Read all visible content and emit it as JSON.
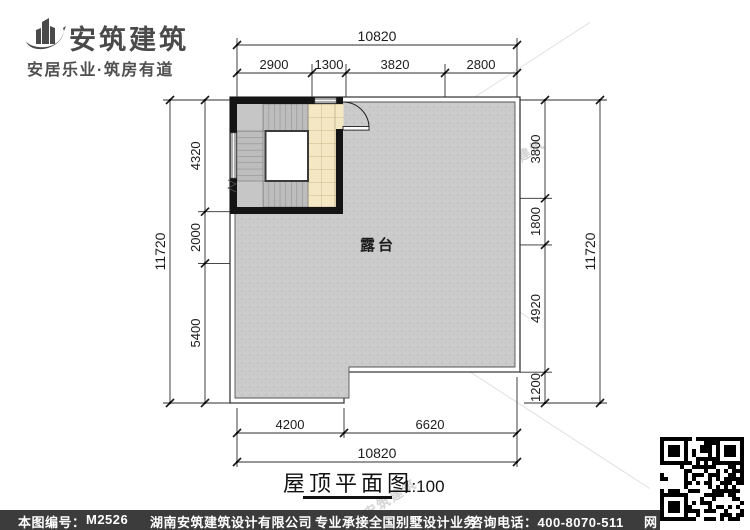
{
  "logo": {
    "title": "安筑建筑",
    "tagline": "安居乐业·筑房有道"
  },
  "plan": {
    "room_label": "露台"
  },
  "dims": {
    "top_total": "10820",
    "top_segments": [
      "2900",
      "1300",
      "3820",
      "2800"
    ],
    "left_total": "11720",
    "left_segments": [
      "4320",
      "2000",
      "5400"
    ],
    "right_total": "11720",
    "right_segments": [
      "3800",
      "1800",
      "4920",
      "1200"
    ],
    "bottom_segments": [
      "4200",
      "6620"
    ],
    "bottom_total": "10820"
  },
  "title_block": {
    "title": "屋顶平面图",
    "scale": "1:100"
  },
  "watermark": {
    "brand": "安筑建筑",
    "frag1": "hnaz",
    "frag2": "om"
  },
  "footer": {
    "sheet_label": "本图编号：",
    "sheet_no": "M2526",
    "company": "湖南安筑建筑设计有限公司",
    "service": "专业承接全国别墅设计业务",
    "phone": "咨询电话：400-8070-511",
    "web_char": "网"
  },
  "colors": {
    "footer_bg": "#3c3c3c",
    "wall": "#141414",
    "terrace_fill": "#cbcbcb",
    "tile_fill": "#f4e7c3",
    "logo_gray": "#4a4a4a"
  }
}
